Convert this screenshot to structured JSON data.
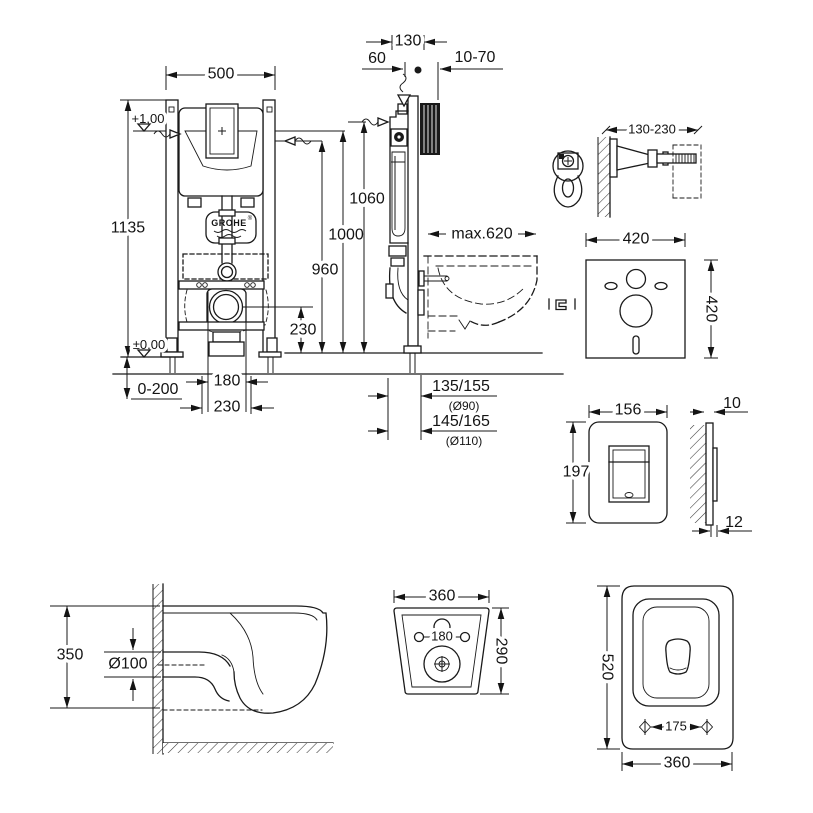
{
  "labels": {
    "front": {
      "width": "500",
      "height": "1135",
      "level_plus": "+1,00",
      "level_zero": "±0,00",
      "feet_range": "0-200",
      "bolt_180": "180",
      "bolt_230": "230",
      "drain_230": "230"
    },
    "heights": {
      "h1060": "1060",
      "h1000": "1000",
      "h960": "960"
    },
    "side": {
      "depth130": "130",
      "d60": "60",
      "wall1070": "10-70",
      "max620": "max.620",
      "out90": "135/155",
      "out90d": "(Ø90)",
      "out110": "145/165",
      "out110d": "(Ø110)"
    },
    "bracket": {
      "range": "130-230"
    },
    "mat": {
      "width": "420",
      "height": "420"
    },
    "plate": {
      "width": "156",
      "height": "197",
      "thick_front": "10",
      "thick_back": "12"
    },
    "bowl_side": {
      "height": "350",
      "drain": "Ø100"
    },
    "bowl_rear": {
      "width": "360",
      "height": "290",
      "bolts": "180"
    },
    "bowl_top": {
      "length": "520",
      "width": "360",
      "bolts": "175"
    },
    "brand": {
      "name": "GROHE",
      "reg": "®"
    }
  },
  "colors": {
    "line": "#1a1a1a",
    "background": "#ffffff"
  }
}
